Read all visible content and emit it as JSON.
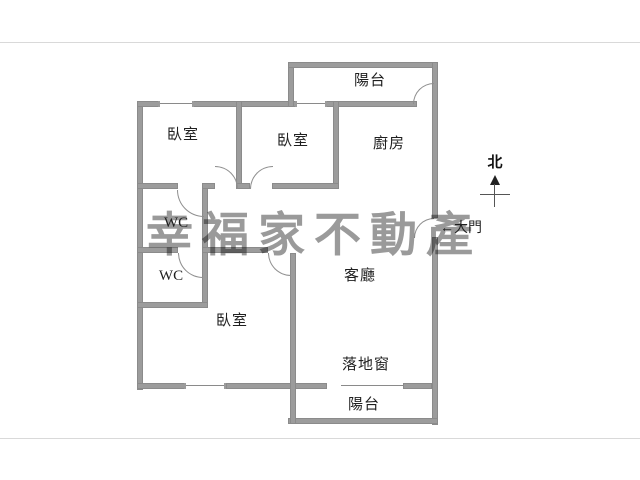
{
  "image": {
    "type": "apartment floor plan",
    "background": "#ffffff",
    "wall_color": "#9c9c9c",
    "line_color": "#8a8a8a",
    "text_color": "#1f1f1f",
    "frame_line_color": "#d9d9d9",
    "watermark_color": "#9a9a9a"
  },
  "watermark": {
    "text": "幸福家不動產"
  },
  "compass": {
    "label": "北"
  },
  "rooms": [
    {
      "id": "balcony-top",
      "label": "陽台"
    },
    {
      "id": "bedroom-1",
      "label": "臥室"
    },
    {
      "id": "bedroom-2",
      "label": "臥室"
    },
    {
      "id": "kitchen",
      "label": "廚房"
    },
    {
      "id": "wc-1",
      "label": "WC"
    },
    {
      "id": "wc-2",
      "label": "WC"
    },
    {
      "id": "living-room",
      "label": "客廳"
    },
    {
      "id": "bedroom-3",
      "label": "臥室"
    },
    {
      "id": "balcony-bottom",
      "label": "陽台"
    }
  ],
  "annotations": [
    {
      "id": "main-door",
      "label": "←大門"
    },
    {
      "id": "floor-window",
      "label": "落地窗"
    }
  ]
}
